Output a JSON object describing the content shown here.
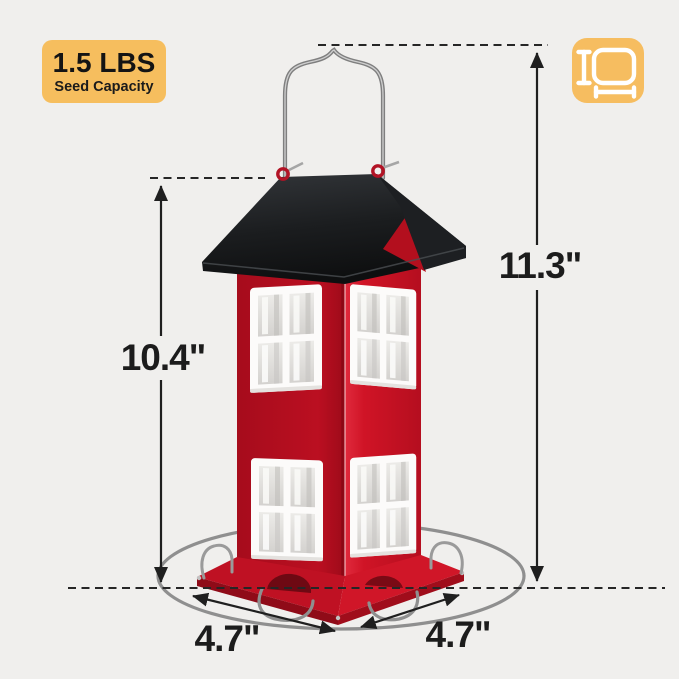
{
  "badge": {
    "capacity": "1.5 LBS",
    "caption": "Seed Capacity",
    "bg_color": "#f6be5e"
  },
  "dimension_icon": {
    "name": "dimensions-measure-icon",
    "bg_color": "#f6bd60",
    "glyph_color": "#ffffff"
  },
  "dimensions": {
    "overall_height": "11.3\"",
    "house_height": "10.4\"",
    "base_width_left": "4.7\"",
    "base_width_right": "4.7\""
  },
  "product": {
    "type": "house-shaped hanging bird feeder",
    "body_color": "#bf1022",
    "roof_color": "#1b1d1f",
    "window_frame_color": "#fcfbfa",
    "tray_color": "#c31425",
    "wire_color": "#8f8f8f",
    "annotation_color": "#1f1f1f",
    "background_color": "#f0efed"
  }
}
